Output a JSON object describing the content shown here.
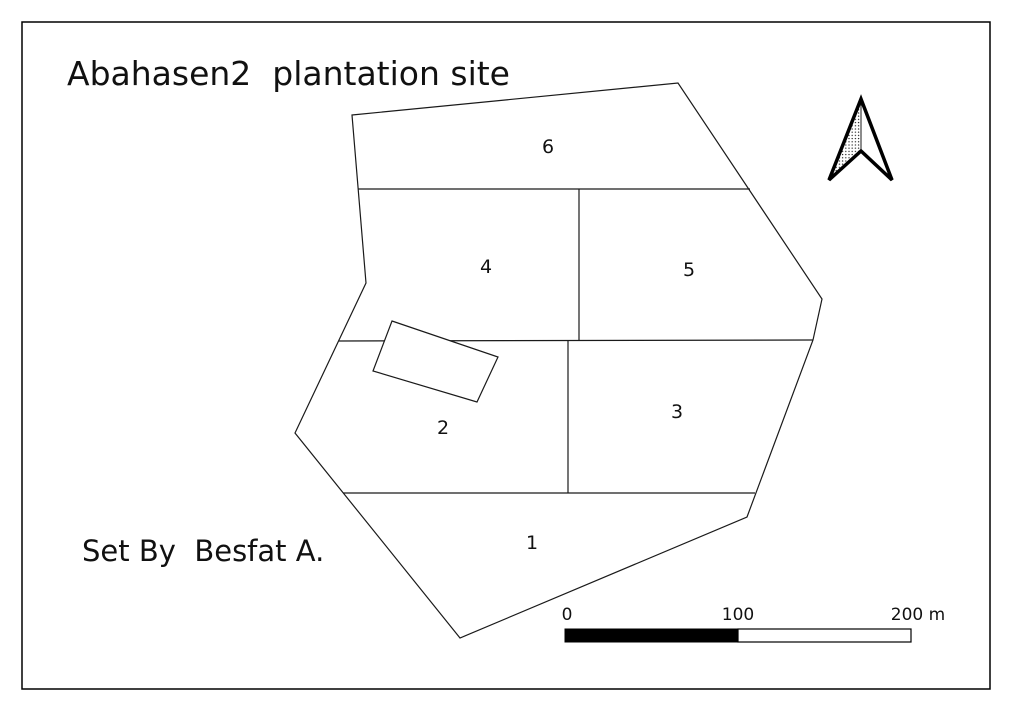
{
  "page": {
    "title": "Abahasen2  plantation site",
    "credit": "Set By  Besfat A."
  },
  "map": {
    "parcels": [
      {
        "label": "1"
      },
      {
        "label": "2"
      },
      {
        "label": "3"
      },
      {
        "label": "4"
      },
      {
        "label": "5"
      },
      {
        "label": "6"
      }
    ],
    "building_overlay": "small rotated rectangle (unlabeled)",
    "north_arrow_icon": "north-arrow-icon",
    "scale_bar": {
      "ticks": [
        "0",
        "100",
        "200 m"
      ],
      "units": "m"
    },
    "colors": {
      "line": "#1a1a1a",
      "frame": "#000000",
      "scale_bar_fill": "#000000",
      "background": "#ffffff",
      "text": "#111111"
    }
  }
}
